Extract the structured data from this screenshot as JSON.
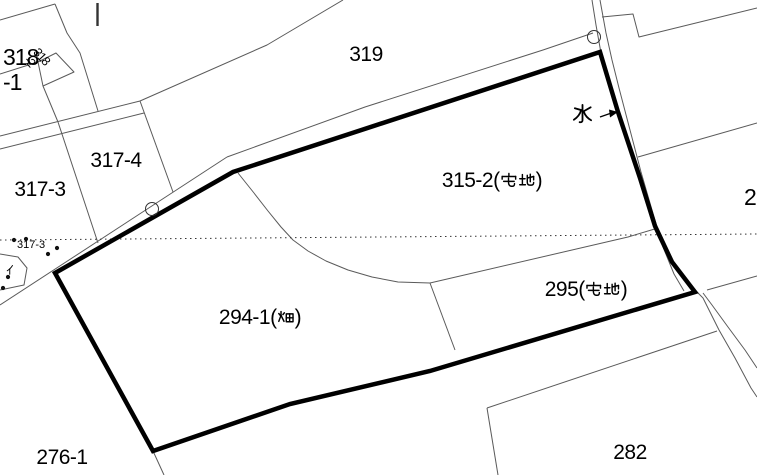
{
  "map": {
    "title": "cadastral-parcel-map",
    "background_color": "#ffffff",
    "bold_outline_color": "#000000",
    "thin_line_color": "#5a5a5a",
    "labels": {
      "p318_1": {
        "full": "318-1",
        "lines": [
          "318",
          "-1"
        ]
      },
      "p318_2": {
        "full": "318-2",
        "lines": [
          "318",
          "-2"
        ],
        "rotation_deg": 48
      },
      "p319": {
        "text": "319"
      },
      "p317_4": {
        "text": "317-4"
      },
      "p317_3": {
        "text": "317-3"
      },
      "p317_3_small": {
        "text": "317-3"
      },
      "p315_2": {
        "full": "315-2(宅地)",
        "before": "315-2(",
        "kanji": "宅地",
        "after": ")"
      },
      "p295": {
        "full": "295(宅地)",
        "before": "295(",
        "kanji": "宅地",
        "after": ")"
      },
      "p294_1": {
        "full": "294-1(畑)",
        "before": "294-1(",
        "kanji": "畑",
        "after": ")"
      },
      "p276_1": {
        "text": "276-1"
      },
      "p282": {
        "text": "282"
      },
      "p2_partial": {
        "text": "2"
      },
      "water": {
        "full": "水",
        "kanji": "水"
      },
      "i_mark": {
        "full": "イ",
        "kanji": "イ"
      }
    }
  }
}
